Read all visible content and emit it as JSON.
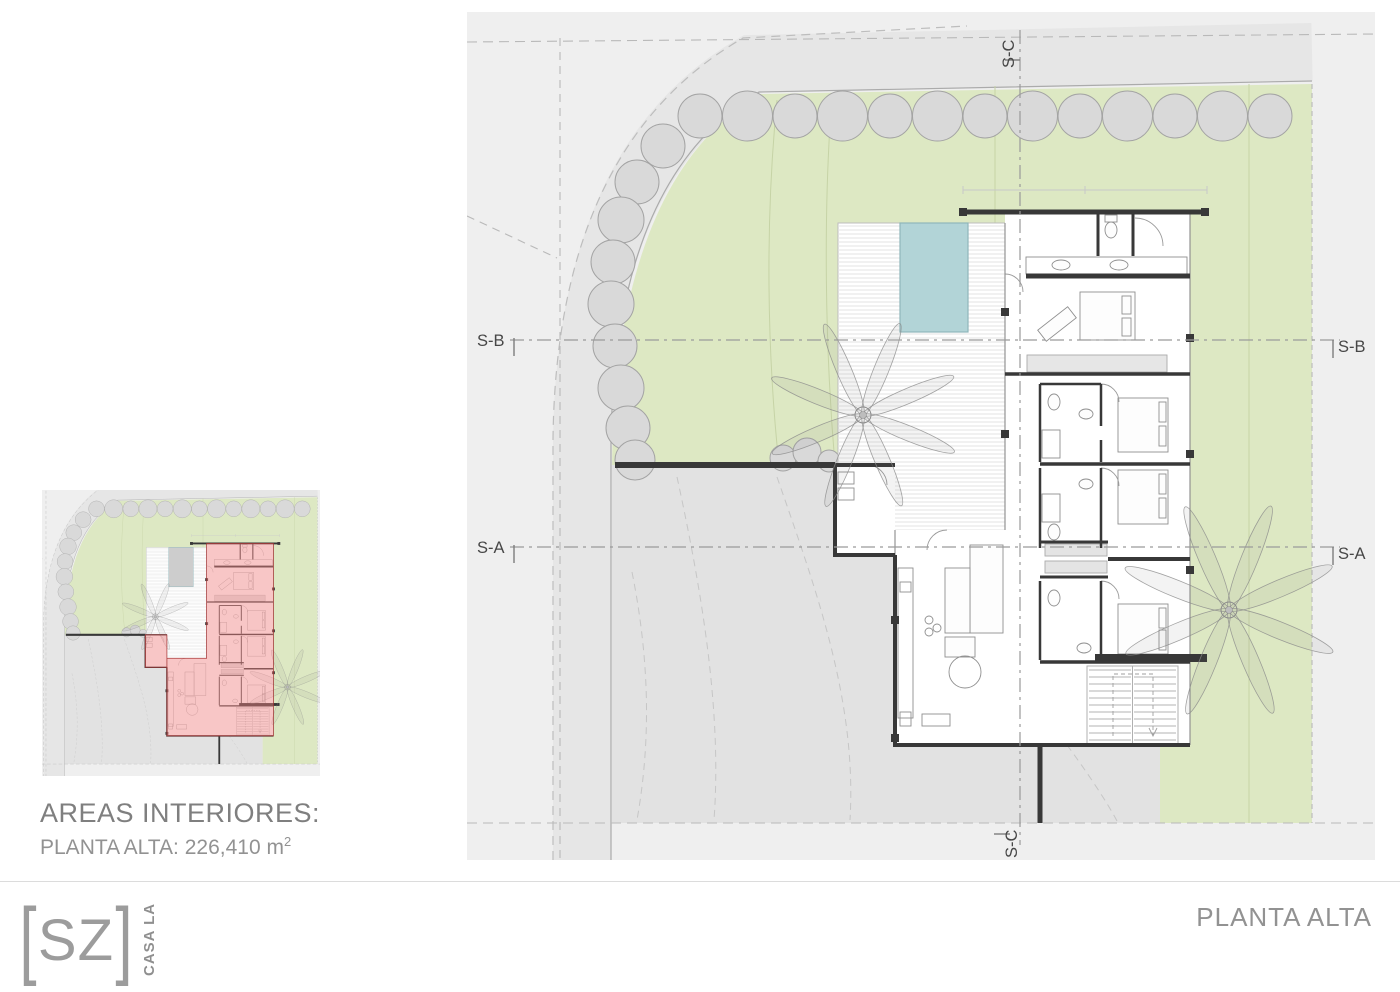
{
  "sheet": {
    "title": "PLANTA ALTA"
  },
  "areas_panel": {
    "heading": "AREAS INTERIORES:",
    "value": "PLANTA ALTA: 226,410 m",
    "value_sup": "2"
  },
  "logo": {
    "bracket_left": "[",
    "initials": "SZ",
    "bracket_right": "]",
    "vertical_text": "CASA LA"
  },
  "section_markers": {
    "sa": "S-A",
    "sb": "S-B",
    "sc": "S-C"
  },
  "colors": {
    "panel_bg": "#efefef",
    "street_grey": "#e2e2e2",
    "road_band": "#e6e6e6",
    "garden_green": "#dde8c3",
    "pool_main": "#b2d4d7",
    "pool_mini": "#cdcdcd",
    "highlight_fill": "rgba(240,128,128,0.45)",
    "highlight_stroke": "#a83636",
    "wall_grey": "#383838",
    "tree_fill": "#d9d9d9",
    "tree_stroke": "#a3a3a3",
    "text_grey": "#8c8c8c",
    "title_grey": "#929292",
    "label_dark": "#474747",
    "logo_grey": "#9c9c9c"
  }
}
